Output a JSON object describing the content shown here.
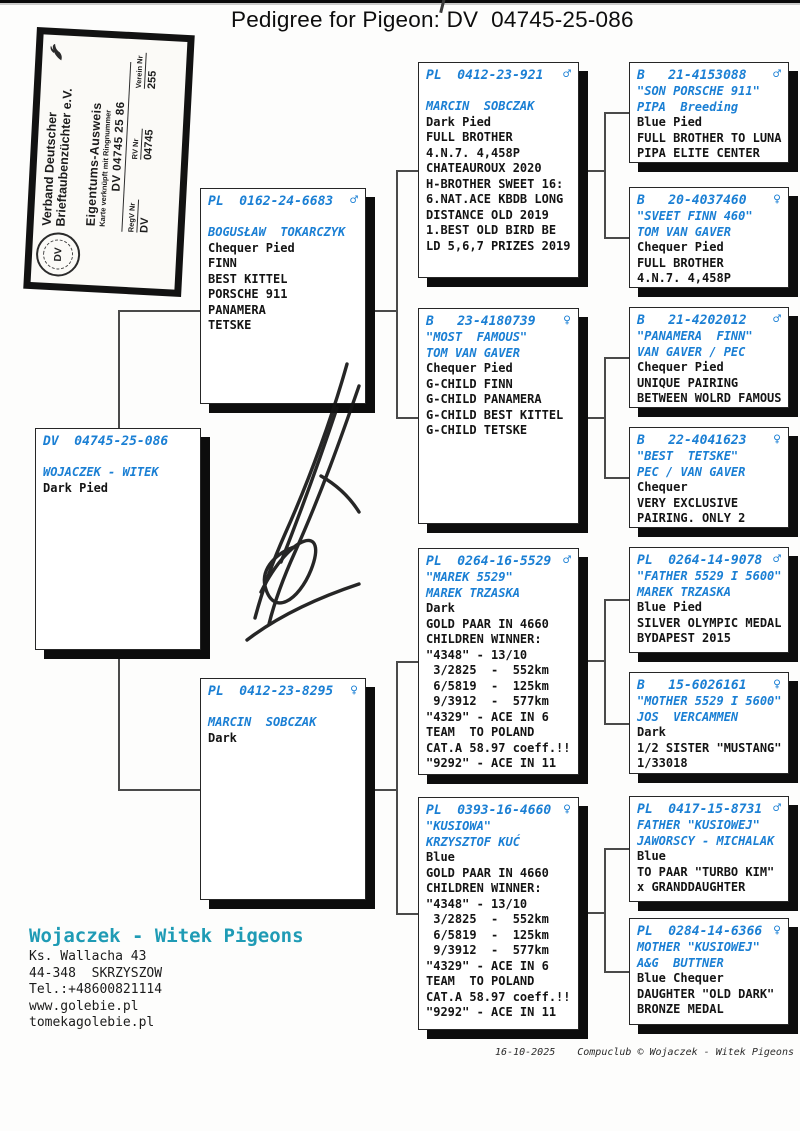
{
  "page": {
    "title": "Pedigree for Pigeon: DV  04745-25-086",
    "footer": {
      "date": "16-10-2025",
      "credit": "Compuclub © Wojaczek - Witek Pigeons"
    }
  },
  "ownership_card": {
    "org_line1": "Verband Deutscher",
    "org_line2": "Brieftaubenzüchter e.V.",
    "doc_title": "Eigentums-Ausweis",
    "doc_subtitle": "Karte verknüpft mit Ringnummer",
    "ring_number": "DV 04745 25 86",
    "seal_text": "DV",
    "fields": [
      {
        "label": "RegV Nr",
        "value": "DV"
      },
      {
        "label": "RV Nr",
        "value": "04745"
      },
      {
        "label": "Verein Nr",
        "value": "255"
      }
    ]
  },
  "contact": {
    "name": "Wojaczek - Witek Pigeons",
    "lines": [
      "Ks. Wallacha 43",
      "44-348  SKRZYSZOW",
      "Tel.:+48600821114",
      "www.golebie.pl",
      "tomekagolebie.pl"
    ]
  },
  "colors": {
    "ring_blue": "#1a7fd4",
    "contact_teal": "#1f9bb5"
  },
  "pedigree": {
    "subject": {
      "ring": "DV  04745-25-086",
      "sex": "",
      "names": [
        "WOJACZEK - WITEK"
      ],
      "info": [
        "Dark Pied"
      ]
    },
    "father": {
      "ring": "PL  0162-24-6683",
      "sex": "♂",
      "names": [
        "BOGUSŁAW  TOKARCZYK"
      ],
      "info": [
        "Chequer Pied",
        "FINN",
        "BEST KITTEL",
        "PORSCHE 911",
        "PANAMERA",
        "TETSKE"
      ]
    },
    "mother": {
      "ring": "PL  0412-23-8295",
      "sex": "♀",
      "names": [
        "MARCIN  SOBCZAK"
      ],
      "info": [
        "Dark"
      ]
    },
    "gp1": {
      "ring": "PL  0412-23-921",
      "sex": "♂",
      "names": [
        "MARCIN  SOBCZAK"
      ],
      "info": [
        "Dark Pied",
        "FULL BROTHER",
        "4.N.7. 4,458P",
        "CHATEAUROUX 2020",
        "H-BROTHER SWEET 16:",
        "6.NAT.ACE KBDB LONG",
        "DISTANCE OLD 2019",
        "1.BEST OLD BIRD BE",
        "LD 5,6,7 PRIZES 2019"
      ]
    },
    "gp2": {
      "ring": "B   23-4180739",
      "sex": "♀",
      "names": [
        "\"MOST  FAMOUS\"",
        "TOM VAN GAVER"
      ],
      "info": [
        "Chequer Pied",
        "G-CHILD FINN",
        "G-CHILD PANAMERA",
        "G-CHILD BEST KITTEL",
        "G-CHILD TETSKE"
      ]
    },
    "gp3": {
      "ring": "PL  0264-16-5529",
      "sex": "♂",
      "names": [
        "\"MAREK 5529\"",
        "MAREK TRZASKA"
      ],
      "info": [
        "Dark",
        "GOLD PAAR IN 4660",
        "CHILDREN WINNER:",
        "\"4348\" - 13/10",
        " 3/2825  -  552km",
        " 6/5819  -  125km",
        " 9/3912  -  577km",
        "\"4329\" - ACE IN 6",
        "TEAM  TO POLAND",
        "CAT.A 58.97 coeff.!!",
        "\"9292\" - ACE IN 11"
      ]
    },
    "gp4": {
      "ring": "PL  0393-16-4660",
      "sex": "♀",
      "names": [
        "\"KUSIOWA\"",
        "KRZYSZTOF KUĆ"
      ],
      "info": [
        "Blue",
        "GOLD PAAR IN 4660",
        "CHILDREN WINNER:",
        "\"4348\" - 13/10",
        " 3/2825  -  552km",
        " 6/5819  -  125km",
        " 9/3912  -  577km",
        "\"4329\" - ACE IN 6",
        "TEAM  TO POLAND",
        "CAT.A 58.97 coeff.!!",
        "\"9292\" - ACE IN 11"
      ]
    },
    "ggp1": {
      "ring": "B   21-4153088",
      "sex": "♂",
      "names": [
        "\"SON PORSCHE 911\"",
        "PIPA  Breeding"
      ],
      "info": [
        "Blue Pied",
        "FULL BROTHER TO LUNA",
        "PIPA ELITE CENTER"
      ]
    },
    "ggp2": {
      "ring": "B   20-4037460",
      "sex": "♀",
      "names": [
        "\"SVEET FINN 460\"",
        "TOM VAN GAVER"
      ],
      "info": [
        "Chequer Pied",
        "FULL BROTHER",
        "4.N.7. 4,458P"
      ]
    },
    "ggp3": {
      "ring": "B   21-4202012",
      "sex": "♂",
      "names": [
        "\"PANAMERA  FINN\"",
        "VAN GAVER / PEC"
      ],
      "info": [
        "Chequer Pied",
        "UNIQUE PAIRING",
        "BETWEEN WOLRD FAMOUS"
      ]
    },
    "ggp4": {
      "ring": "B   22-4041623",
      "sex": "♀",
      "names": [
        "\"BEST  TETSKE\"",
        "PEC / VAN GAVER"
      ],
      "info": [
        "Chequer",
        "VERY EXCLUSIVE",
        "PAIRING. ONLY 2"
      ]
    },
    "ggp5": {
      "ring": "PL  0264-14-9078",
      "sex": "♂",
      "names": [
        "\"FATHER 5529 I 5600\"",
        "MAREK TRZASKA"
      ],
      "info": [
        "Blue Pied",
        "SILVER OLYMPIC MEDAL",
        "BYDAPEST 2015"
      ]
    },
    "ggp6": {
      "ring": "B   15-6026161",
      "sex": "♀",
      "names": [
        "\"MOTHER 5529 I 5600\"",
        "JOS  VERCAMMEN"
      ],
      "info": [
        "Dark",
        "1/2 SISTER \"MUSTANG\"",
        "1/33018"
      ]
    },
    "ggp7": {
      "ring": "PL  0417-15-8731",
      "sex": "♂",
      "names": [
        "FATHER \"KUSIOWEJ\"",
        "JAWORSCY - MICHALAK"
      ],
      "info": [
        "Blue",
        "TO PAAR \"TURBO KIM\"",
        "x GRANDDAUGHTER"
      ]
    },
    "ggp8": {
      "ring": "PL  0284-14-6366",
      "sex": "♀",
      "names": [
        "MOTHER \"KUSIOWEJ\"",
        "A&G  BUTTNER"
      ],
      "info": [
        "Blue Chequer",
        "DAUGHTER \"OLD DARK\"",
        "BRONZE MEDAL"
      ]
    }
  }
}
